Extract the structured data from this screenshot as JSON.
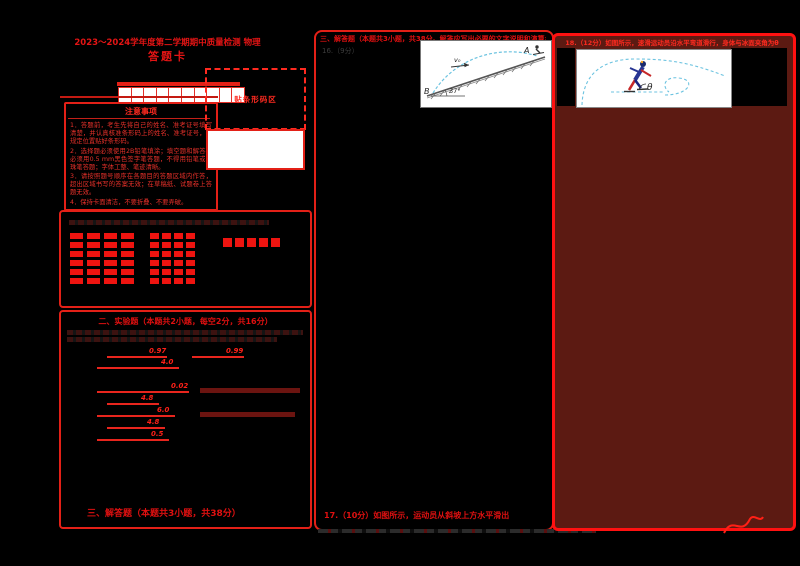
{
  "title": {
    "line1": "2023～2024学年度第二学期期中质量检测 物理",
    "line2": "答题卡"
  },
  "barcode": {
    "label": "贴条形码区"
  },
  "notice": {
    "title": "注意事项",
    "items": [
      "1．答题前，考生先将自己的姓名、准考证号填写清楚，并认真核准条形码上的姓名、准考证号，在规定位置贴好条形码。",
      "2．选择题必须使用2B铅笔填涂；填空题和解答题必须用0.5 mm黑色签字笔答题，不得用铅笔或圆珠笔答题；字体工整、笔迹清晰。",
      "3．请按照题号顺序在各题目的答题区域内作答，超出区域书写的答案无效；在草稿纸、试题卷上答题无效。",
      "4．保持卡面清洁，不要折叠、不要弄破。"
    ]
  },
  "exam_grid": {
    "cells": 10
  },
  "choice": {
    "clusters": [
      {
        "x": 9,
        "y": 21,
        "cols": 4,
        "rows": 6,
        "cw": 13,
        "ch": 6,
        "gx": 4,
        "gy": 3
      },
      {
        "x": 89,
        "y": 21,
        "cols": 4,
        "rows": 6,
        "cw": 9,
        "ch": 6,
        "gx": 3,
        "gy": 3
      }
    ],
    "squares": {
      "x": 162,
      "y": 26,
      "count": 5,
      "size": 9,
      "gap": 3
    }
  },
  "fill": {
    "header": "二、实验题（本题共2小题，每空2分，共16分）",
    "rows": [
      {
        "y": 35,
        "segments": [
          {
            "x": 46,
            "w": 60,
            "answer": "0.97"
          },
          {
            "x": 131,
            "w": 52,
            "answer": "0.99"
          }
        ]
      },
      {
        "y": 46,
        "segments": [
          {
            "x": 36,
            "w": 82,
            "answer": "4.0"
          }
        ]
      },
      {
        "y": 70,
        "segments": [
          {
            "x": 36,
            "w": 92,
            "answer": "0.02"
          }
        ],
        "band": {
          "x": 139,
          "w": 100
        }
      },
      {
        "y": 82,
        "segments": [
          {
            "x": 46,
            "w": 52,
            "answer": "4.8"
          }
        ]
      },
      {
        "y": 94,
        "segments": [
          {
            "x": 36,
            "w": 78,
            "answer": "6.0"
          }
        ],
        "band": {
          "x": 139,
          "w": 95
        }
      },
      {
        "y": 106,
        "segments": [
          {
            "x": 46,
            "w": 58,
            "answer": "4.8"
          }
        ]
      },
      {
        "y": 118,
        "segments": [
          {
            "x": 36,
            "w": 72,
            "answer": "0.5"
          }
        ]
      }
    ],
    "footer": "三、解答题（本题共3小题，共38分）"
  },
  "q16": {
    "header": "三、解答题（本题共3小题，共38分。解答应写出必要的文字说明和演算步骤）",
    "number": "16.（9分）",
    "footer": "17.（10分）如图所示，运动员从斜坡上方水平滑出",
    "diagram": {
      "a": "A",
      "b": "B",
      "angle": "37°",
      "v0": "v₀"
    }
  },
  "q18": {
    "header": "18.（12分）如图所示，速滑运动员沿水平弯道滑行，身体与冰面夹角为θ",
    "diagram": {
      "theta": "θ"
    }
  },
  "colors": {
    "accent_red": "#e32017",
    "ink_maroon": "#5c1a12",
    "bubble_red": "#ee1410",
    "trajectory_blue": "#6cc3e0",
    "background": "#000000"
  }
}
